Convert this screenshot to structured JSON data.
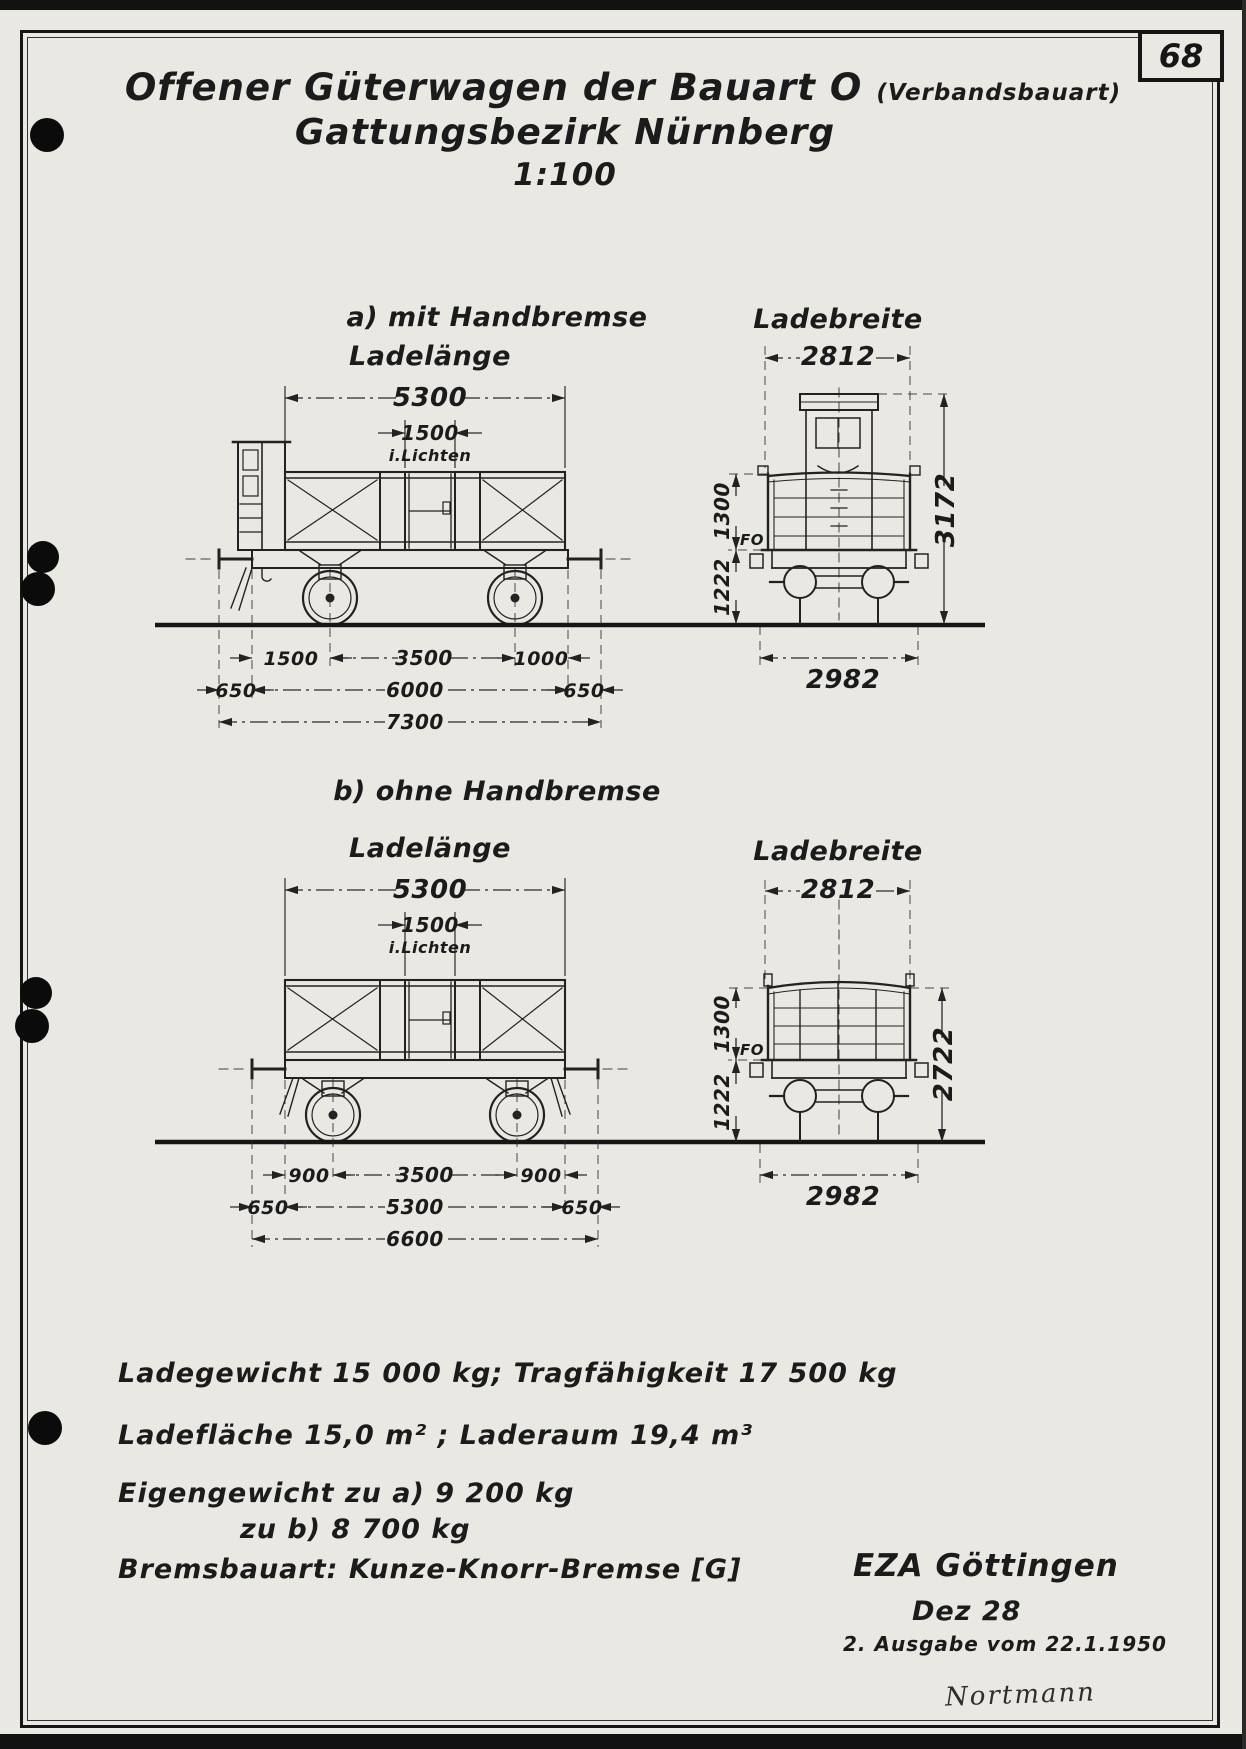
{
  "colors": {
    "paper": "#eae8e3",
    "ink": "#1d1d1d"
  },
  "page": {
    "number": "68",
    "title": "Offener Güterwagen der Bauart O",
    "title_note": "(Verbandsbauart)",
    "subtitle": "Gattungsbezirk Nürnberg",
    "scale": "1:100"
  },
  "section_a": {
    "heading": "a) mit Handbremse",
    "load_length_label": "Ladelänge",
    "load_length": "5300",
    "door_width": "1500",
    "door_note": "i.Lichten",
    "row1": [
      "1500",
      "3500",
      "1000"
    ],
    "row2": [
      "650",
      "6000",
      "650"
    ],
    "total": "7300",
    "load_width_label": "Ladebreite",
    "load_width": "2812",
    "wall_height": "1300",
    "floor_mark": "FO",
    "floor_height": "1222",
    "overall_height": "3172",
    "overall_width": "2982"
  },
  "section_b": {
    "heading": "b) ohne Handbremse",
    "load_length_label": "Ladelänge",
    "load_length": "5300",
    "door_width": "1500",
    "door_note": "i.Lichten",
    "row1": [
      "900",
      "3500",
      "900"
    ],
    "row2": [
      "650",
      "5300",
      "650"
    ],
    "total": "6600",
    "load_width_label": "Ladebreite",
    "load_width": "2812",
    "wall_height": "1300",
    "floor_mark": "FO",
    "floor_height": "1222",
    "overall_height": "2722",
    "overall_width": "2982"
  },
  "specs": {
    "load_weight": "Ladegewicht 15 000 kg; Tragfähigkeit 17 500 kg",
    "load_area": "Ladefläche  15,0 m² ; Laderaum 19,4 m³",
    "tare_a": "Eigengewicht zu a) 9 200 kg",
    "tare_b": "zu b) 8 700 kg",
    "brake": "Bremsbauart: Kunze-Knorr-Bremse [G]"
  },
  "footer": {
    "office": "EZA Göttingen",
    "date": "Dez 28",
    "edition": "2. Ausgabe vom 22.1.1950",
    "signature": "Nortmann"
  }
}
